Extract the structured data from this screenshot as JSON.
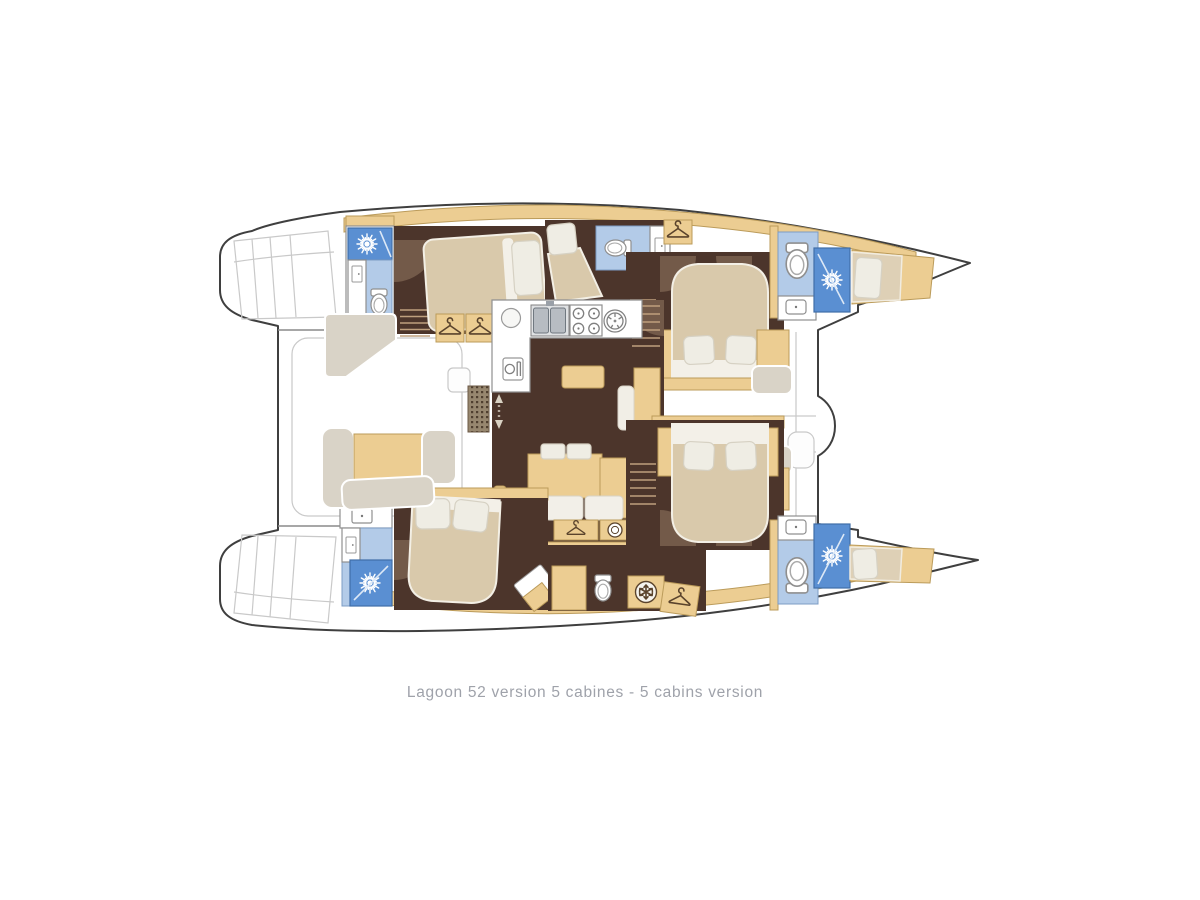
{
  "caption": {
    "text": "Lagoon 52 version 5 cabines - 5 cabins version"
  },
  "palette": {
    "outline": "#3f3f3f",
    "faint": "#c9c9c9",
    "floor": "#4c352b",
    "floor_light": "#9a8068",
    "tan": "#eccd92",
    "tan_border": "#bb9b5a",
    "bed": "#d9c9ab",
    "pillow": "#efede4",
    "pillow_border": "#d6d1c3",
    "taupe": "#d9d3c7",
    "blue_light": "#b3cbe8",
    "blue_dark": "#5a8fd2",
    "steel": "#b7bcc2",
    "counter_border": "#8f8f8f",
    "icon_dark": "#5a432c",
    "text": "#9fa2aa"
  },
  "icons": {
    "shower": "sunburst-icon",
    "toilet": "toilet-icon",
    "wardrobe": "hanger-icon",
    "fridge": "snowflake-icon",
    "galley_table": "dining-icon",
    "stove": "burners-icon",
    "sink": "basin-icon",
    "door": "door-icon",
    "companionway": "arrow-icon"
  }
}
